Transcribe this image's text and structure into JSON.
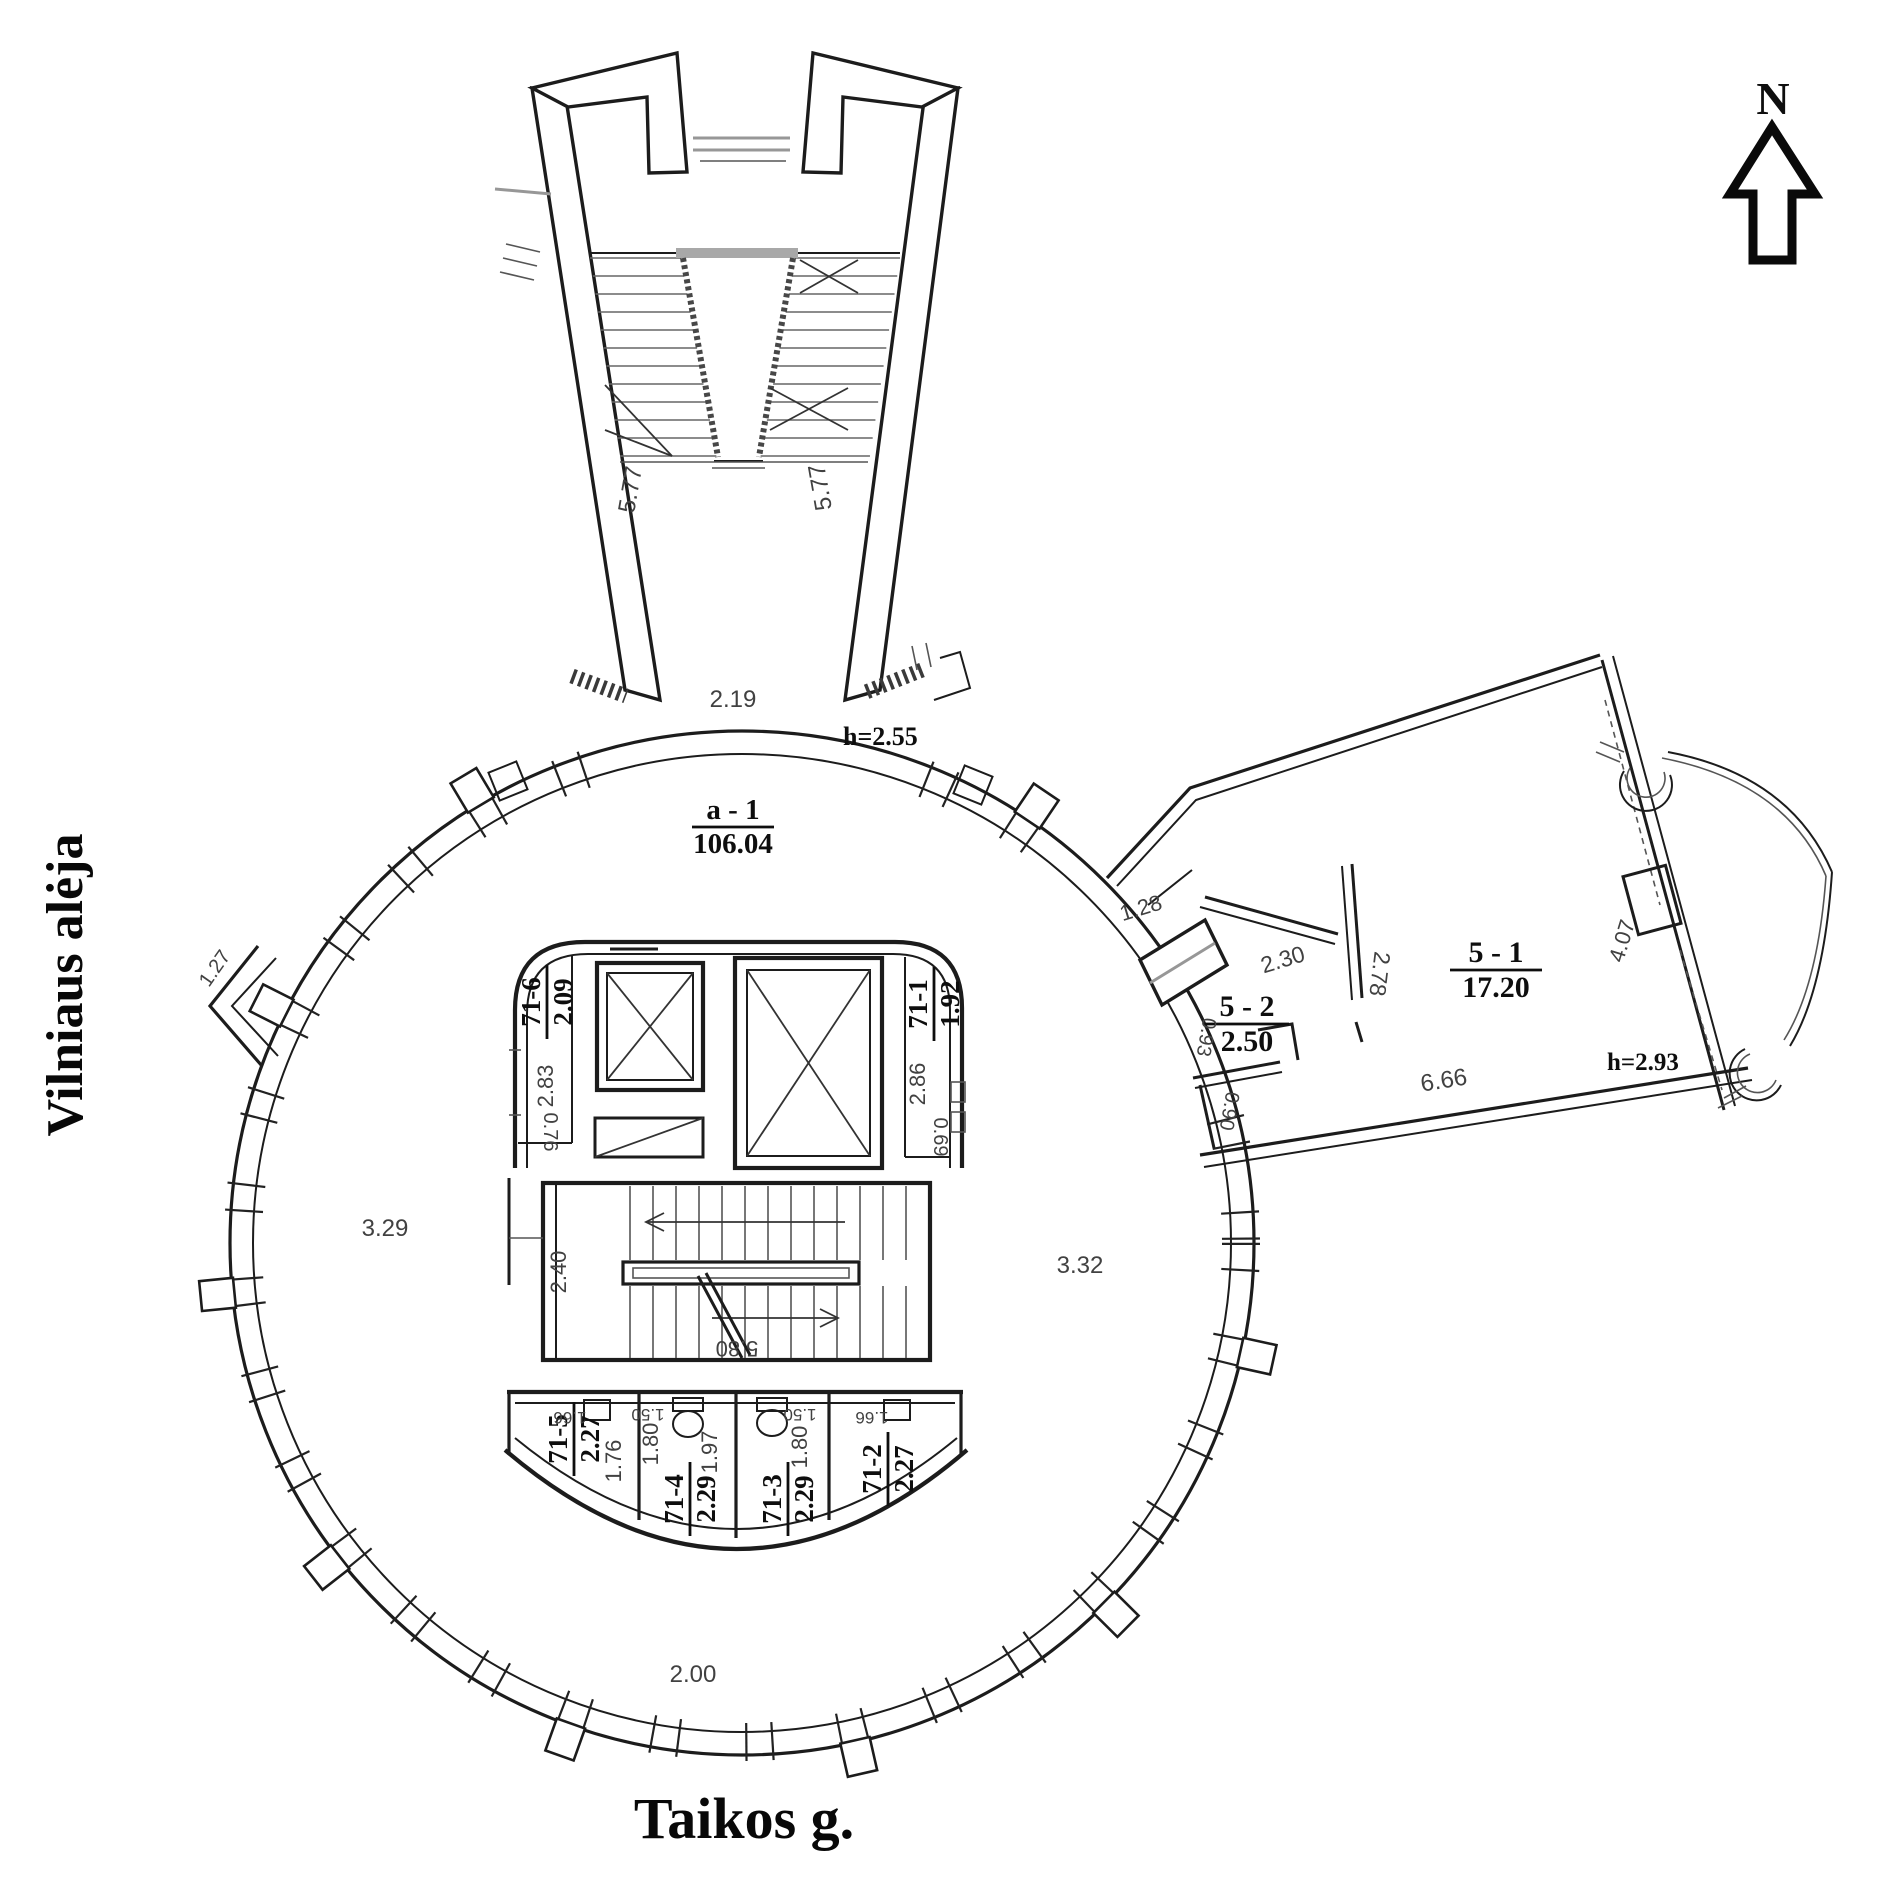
{
  "canvas": {
    "background": "#ffffff",
    "ink": "#1a1a1a",
    "dim_ink": "#454545",
    "faint_ink": "#8a8a8a"
  },
  "streets": {
    "left": "Vilniaus alėja",
    "bottom": "Taikos g."
  },
  "compass": {
    "north": "N"
  },
  "hall": {
    "code": "a - 1",
    "area": "106.04"
  },
  "stairway": {
    "flight_left": "5.77",
    "flight_right": "5.77",
    "entrance_width": "2.19",
    "height_note": "h=2.55"
  },
  "rotunda": {
    "d_upper_left": "1.27",
    "d_left": "3.29",
    "d_right": "3.32",
    "d_bottom": "2.00",
    "d_junction": "1.28"
  },
  "core": {
    "stairwell": {
      "width": "2.40",
      "length": "5.80"
    },
    "rooms": {
      "r716": {
        "code": "71-6",
        "area": "2.09",
        "depth": "2.83",
        "width": "0.76"
      },
      "r711": {
        "code": "71-1",
        "area": "1.92",
        "depth": "2.86",
        "width": "0.69"
      },
      "r715": {
        "code": "71-5",
        "area": "2.27",
        "width": "1.66",
        "depth": "1.76"
      },
      "r714": {
        "code": "71-4",
        "area": "2.29",
        "side": "1.80",
        "top": "1.50",
        "depth": "1.97"
      },
      "r713": {
        "code": "71-3",
        "area": "2.29",
        "top": "1.50",
        "side": "1.80"
      },
      "r712": {
        "code": "71-2",
        "area": "2.27",
        "width": "1.66"
      }
    }
  },
  "wing": {
    "rooms": {
      "r51": {
        "code": "5 - 1",
        "area": "17.20"
      },
      "r52": {
        "code": "5 - 2",
        "area": "2.50"
      }
    },
    "dims": {
      "top": "2.30",
      "partition": "2.78",
      "left": "0.93",
      "inner": "0.90",
      "bottom": "6.66",
      "facade": "4.07",
      "height_note": "h=2.93"
    }
  }
}
